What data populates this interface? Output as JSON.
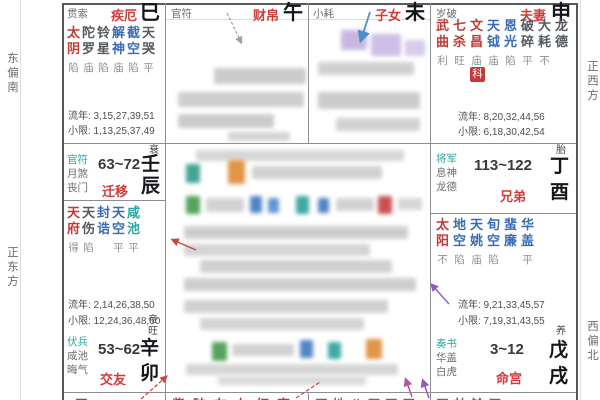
{
  "colors": {
    "red": "#c03a36",
    "blue": "#3a6cb4",
    "teal": "#2aa6a0",
    "gray": "#555a60",
    "god_gray": "#6b6f73",
    "palace_red": "#d03c38",
    "badge_red": "#c5383c"
  },
  "edge_labels": {
    "left_top": "东偏南",
    "left_bottom": "正东方",
    "right_top": "正西方",
    "right_bottom": "西偏北"
  },
  "palaces": {
    "si": {
      "god": "贯索",
      "name": "疾厄",
      "branch": "巳",
      "stars": [
        {
          "name": "太阴",
          "status": "陷",
          "color": "red"
        },
        {
          "name": "陀罗",
          "status": "庙",
          "color": "gray"
        },
        {
          "name": "铃星",
          "status": "陷",
          "color": "gray"
        },
        {
          "name": "解神",
          "status": "庙",
          "color": "blue"
        },
        {
          "name": "截空",
          "status": "陷",
          "color": "blue"
        },
        {
          "name": "天哭",
          "status": "平",
          "color": "gray"
        }
      ],
      "liunian": "流年: 3,15,27,39,51",
      "xiaoxian": "小限: 1,13,25,37,49"
    },
    "wu": {
      "god": "官符",
      "name": "财帛",
      "branch": "午"
    },
    "wei": {
      "god": "小耗",
      "name": "子女",
      "branch": "未"
    },
    "shen": {
      "god": "岁破",
      "name": "夫妻",
      "branch": "申",
      "stars": [
        {
          "name": "武曲",
          "status": "利",
          "color": "red"
        },
        {
          "name": "七杀",
          "status": "旺",
          "color": "red"
        },
        {
          "name": "文昌",
          "status": "庙",
          "color": "red"
        },
        {
          "name": "天钺",
          "status": "庙",
          "color": "blue"
        },
        {
          "name": "恩光",
          "status": "陷",
          "color": "blue"
        },
        {
          "name": "破碎",
          "status": "平",
          "color": "gray"
        },
        {
          "name": "大耗",
          "status": "不",
          "color": "gray"
        },
        {
          "name": "龙德",
          "status": "",
          "color": "gray"
        }
      ],
      "badge": "科",
      "liunian": "流年: 8,20,32,44,56",
      "xiaoxian": "小限: 6,18,30,42,54"
    },
    "chen": {
      "gods": [
        "官符",
        "月煞",
        "丧门"
      ],
      "range": "63~72",
      "name": "迁移",
      "stem": "壬",
      "branch": "辰",
      "stage": "衰"
    },
    "you": {
      "gods": [
        "将军",
        "息神",
        "龙德"
      ],
      "range": "113~122",
      "name": "兄弟",
      "stem": "丁",
      "branch": "酉",
      "stage": "胎"
    },
    "mao": {
      "stars": [
        {
          "name": "天府",
          "status": "得",
          "color": "red"
        },
        {
          "name": "天伤",
          "status": "陷",
          "color": "gray"
        },
        {
          "name": "封诰",
          "status": "",
          "color": "blue"
        },
        {
          "name": "天空",
          "status": "平",
          "color": "blue"
        },
        {
          "name": "咸池",
          "status": "平",
          "color": "teal"
        }
      ],
      "liunian": "流年: 2,14,26,38,50",
      "xiaoxian": "小限: 12,24,36,48,60",
      "gods": [
        "伏兵",
        "咸池",
        "晦气"
      ],
      "range": "53~62",
      "name": "交友",
      "stem": "辛",
      "branch": "卯",
      "stage": "帝旺"
    },
    "xu": {
      "stars": [
        {
          "name": "太阳",
          "status": "不",
          "color": "red"
        },
        {
          "name": "地空",
          "status": "陷",
          "color": "blue"
        },
        {
          "name": "天姚",
          "status": "庙",
          "color": "blue"
        },
        {
          "name": "旬空",
          "status": "陷",
          "color": "blue"
        },
        {
          "name": "蜚廉",
          "status": "",
          "color": "blue"
        },
        {
          "name": "华盖",
          "status": "平",
          "color": "blue"
        }
      ],
      "liunian": "流年: 9,21,33,45,57",
      "xiaoxian": "小限: 7,19,31,43,55",
      "gods": [
        "奏书",
        "华盖",
        "白虎"
      ],
      "range": "3~12",
      "name": "命宫",
      "stem": "戊",
      "branch": "戌",
      "stage": "养"
    }
  },
  "bottom_row": {
    "cells": [
      "天",
      "紫破左右红寡",
      "天地八天天天",
      "天劫铃天"
    ]
  }
}
